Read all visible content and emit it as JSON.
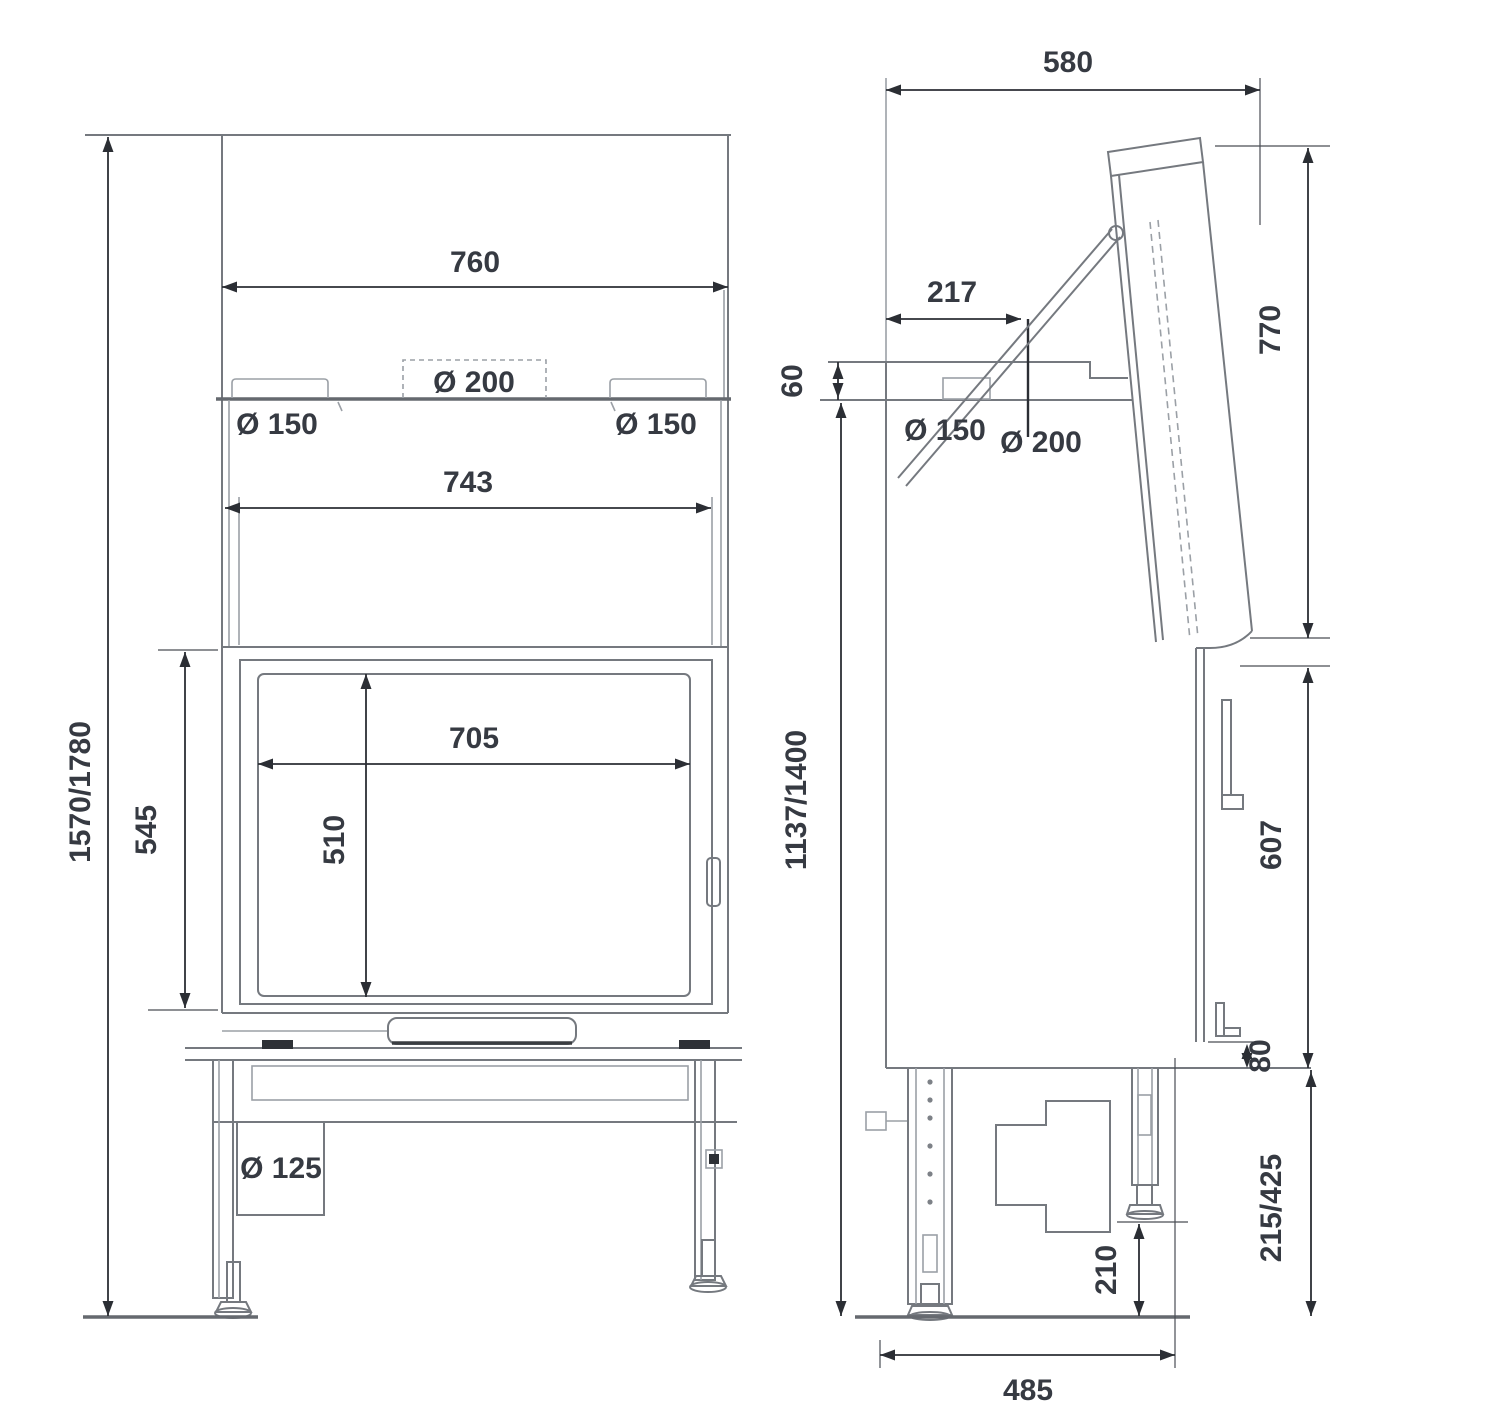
{
  "drawing_title": "fireplace-insert-dimension-drawing",
  "front": {
    "total_height": "1570/1780",
    "top_width": "760",
    "inner_width": "743",
    "glass_width": "705",
    "glass_height": "510",
    "door_height": "545",
    "flue_left": "Ø 150",
    "flue_center": "Ø 200",
    "flue_right": "Ø 150",
    "air_intake": "Ø 125"
  },
  "side": {
    "depth": "580",
    "flue_offset": "217",
    "top_step": "60",
    "hood_height": "770",
    "flue_side": "Ø 150",
    "flue_center": "Ø 200",
    "install_height": "1137/1400",
    "front_panel_height": "607",
    "rear_gap": "80",
    "base_height": "215/425",
    "foot_clearance": "210",
    "base_depth": "485"
  }
}
